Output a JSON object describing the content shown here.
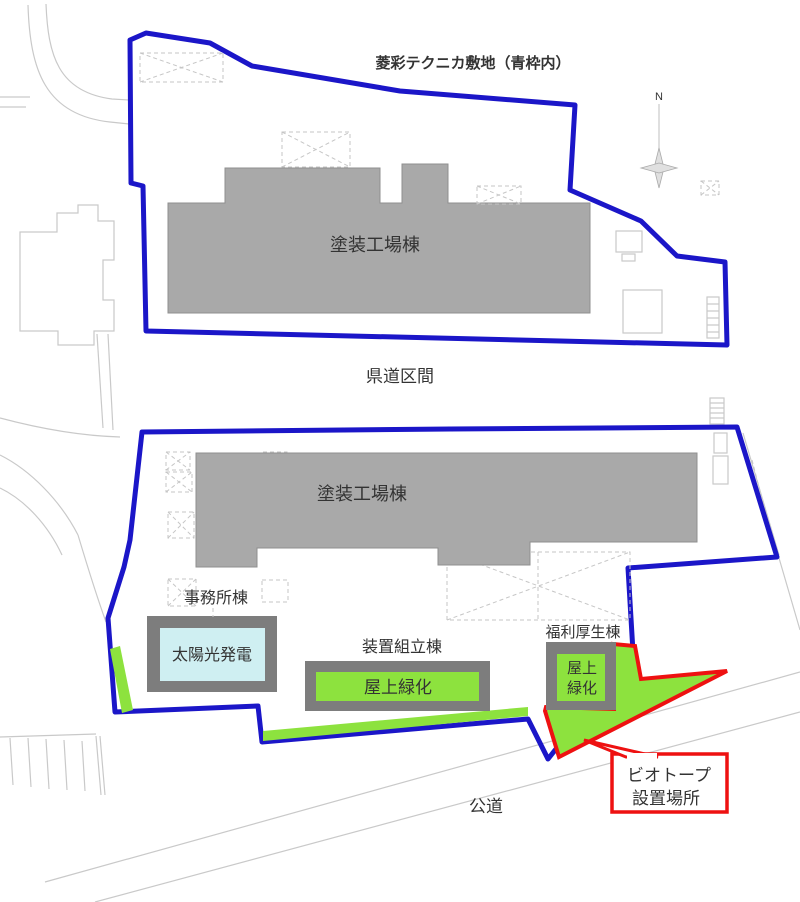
{
  "labels": {
    "title": "菱彩テクニカ敷地（青枠内）",
    "upper_factory": "塗装工場棟",
    "prefectural_road": "県道区間",
    "lower_factory": "塗装工場棟",
    "office": "事務所棟",
    "solar": "太陽光発電",
    "assembly": "装置組立棟",
    "rooftop_green": "屋上緑化",
    "welfare": "福利厚生棟",
    "rooftop_green2_l1": "屋上",
    "rooftop_green2_l2": "緑化",
    "biotope_l1": "ビオトープ",
    "biotope_l2": "設置場所",
    "public_road": "公道",
    "north": "N"
  },
  "colors": {
    "boundary_blue": "#1B16C8",
    "biotope_red": "#EE1111",
    "roof_green": "#8DE23E",
    "solar_cyan": "#CFEFF2",
    "building_gray": "#A9A9A9",
    "building_edge": "#8F8F8F",
    "frame_gray": "#7D7D7D",
    "label_dark": "#3A3A3A"
  }
}
